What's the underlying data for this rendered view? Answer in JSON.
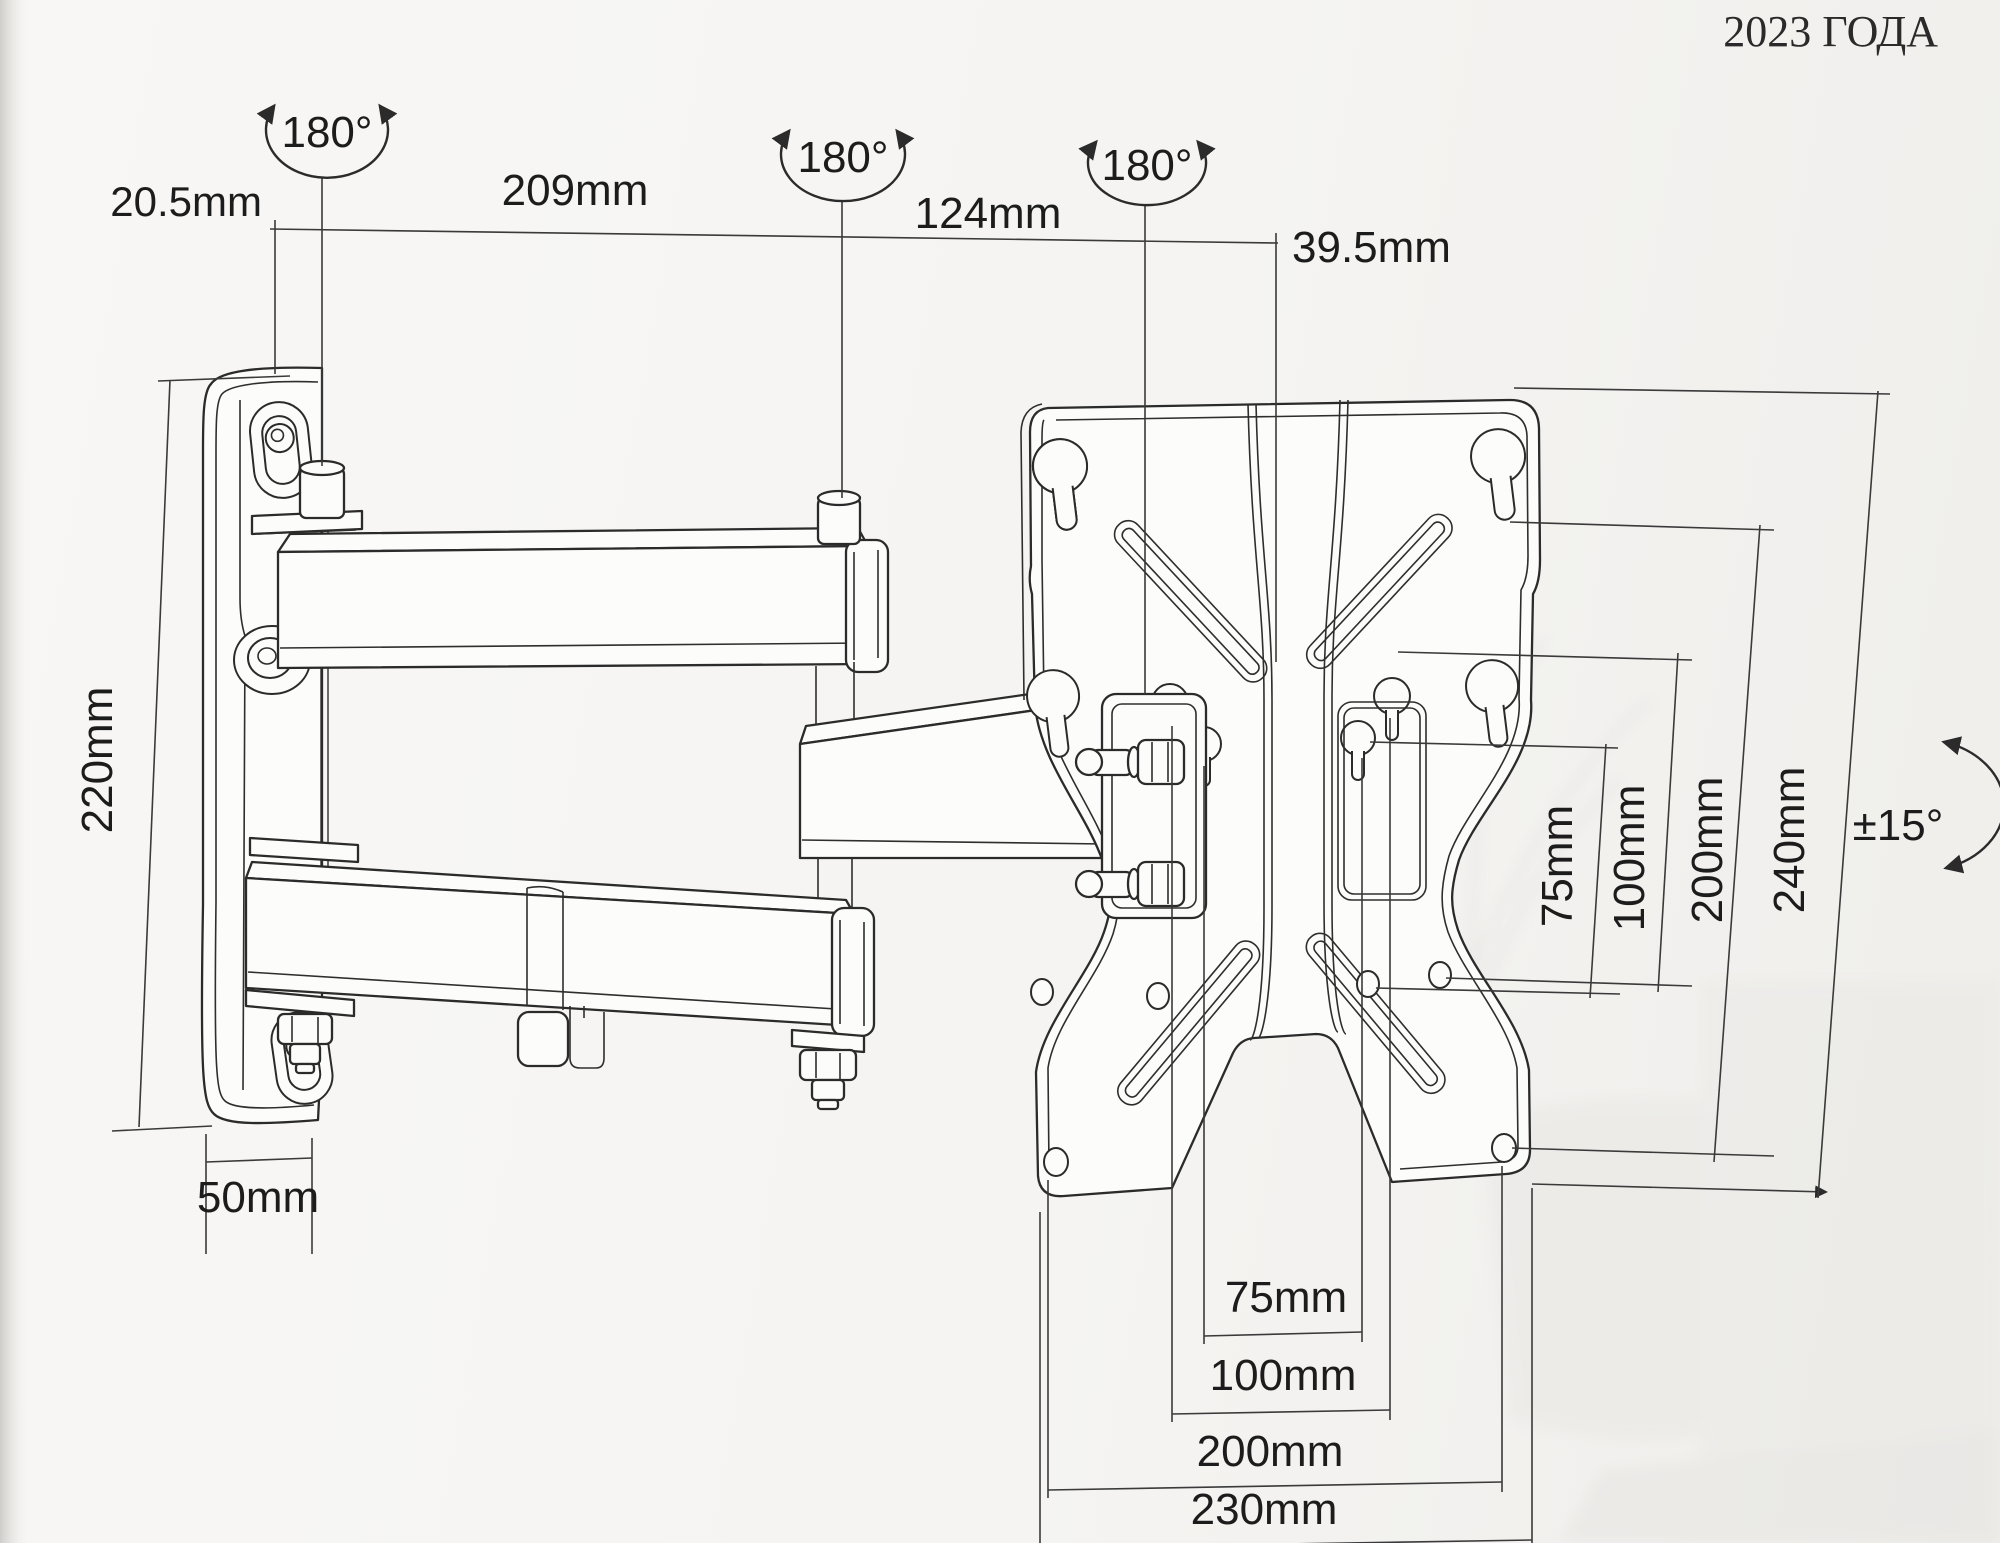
{
  "page": {
    "year_label": "2023 ГОДА"
  },
  "diagram": {
    "unit": "mm",
    "swivel": {
      "wall_pivot_label": "180°",
      "elbow_pivot_label": "180°",
      "vesa_pivot_label": "180°"
    },
    "tilt": {
      "label": "±15°"
    },
    "top_dimensions": {
      "wall_offset": "20.5mm",
      "arm_main": "209mm",
      "arm_front": "124mm",
      "vesa_offset": "39.5mm"
    },
    "wall_plate": {
      "height": "220mm",
      "width": "50mm"
    },
    "vesa_vertical": {
      "v75": "75mm",
      "v100": "100mm",
      "v200": "200mm",
      "v240": "240mm"
    },
    "vesa_horizontal": {
      "h75": "75mm",
      "h100": "100mm",
      "h200": "200mm",
      "h230": "230mm"
    }
  }
}
